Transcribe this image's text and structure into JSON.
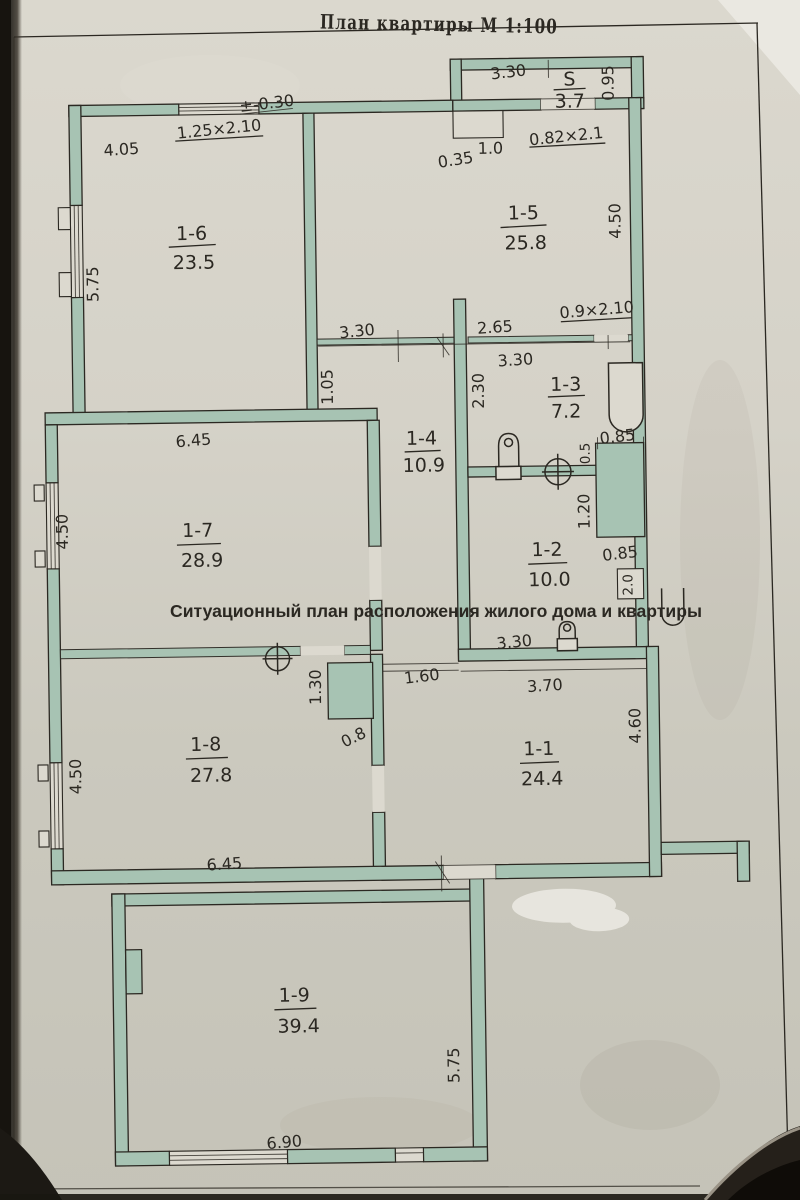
{
  "page": {
    "title": "План квартиры М 1:100",
    "caption": "Ситуационный план расположения жилого дома и квартиры"
  },
  "colors": {
    "paper": "#d6d3c9",
    "paper_light": "#dcd9cf",
    "paper_dark": "#c6c4b9",
    "wall": "#a7c3b3",
    "ink": "#2b2822",
    "edge_dark": "#17140f",
    "whiteout": "#e7e5de"
  },
  "rooms": [
    {
      "id": "S",
      "label": "S",
      "area": "3.7"
    },
    {
      "id": "1-6",
      "label": "1-6",
      "area": "23.5"
    },
    {
      "id": "1-5",
      "label": "1-5",
      "area": "25.8"
    },
    {
      "id": "1-3",
      "label": "1-3",
      "area": "7.2"
    },
    {
      "id": "1-4",
      "label": "1-4",
      "area": "10.9"
    },
    {
      "id": "1-7",
      "label": "1-7",
      "area": "28.9"
    },
    {
      "id": "1-2",
      "label": "1-2",
      "area": "10.0"
    },
    {
      "id": "1-8",
      "label": "1-8",
      "area": "27.8"
    },
    {
      "id": "1-1",
      "label": "1-1",
      "area": "24.4"
    },
    {
      "id": "1-9",
      "label": "1-9",
      "area": "39.4"
    }
  ],
  "dims": {
    "annex_width": "3.30",
    "annex_depth": "0.95",
    "annex_door": "0.82×2.1",
    "annex_notch_w": "1.0",
    "annex_notch_d": "0.35",
    "r16_width": "4.05",
    "r16_window": "1.25×2.10",
    "elevation": "±-0.30",
    "r16_left": "5.75",
    "r15_right": "4.50",
    "mid_left": "3.30",
    "mid_center": "2.65",
    "mid_door": "0.9×2.10",
    "mid_right": "3.30",
    "hall_w": "1.05",
    "bath_w": "2.30",
    "r17_width": "6.45",
    "r17_left": "4.50",
    "duct_top": "0.85",
    "duct_s": "0.5",
    "duct_h": "1.20",
    "duct_bottom": "0.85",
    "duct2": "2.0",
    "r12_w": "3.30",
    "opening": "1.60",
    "r11_w": "3.70",
    "r11_right": "4.60",
    "stove_w": "1.30",
    "stove_d": "0.8",
    "r18_left": "4.50",
    "r18_width": "6.45",
    "r19_right": "5.75",
    "r19_width": "6.90"
  }
}
